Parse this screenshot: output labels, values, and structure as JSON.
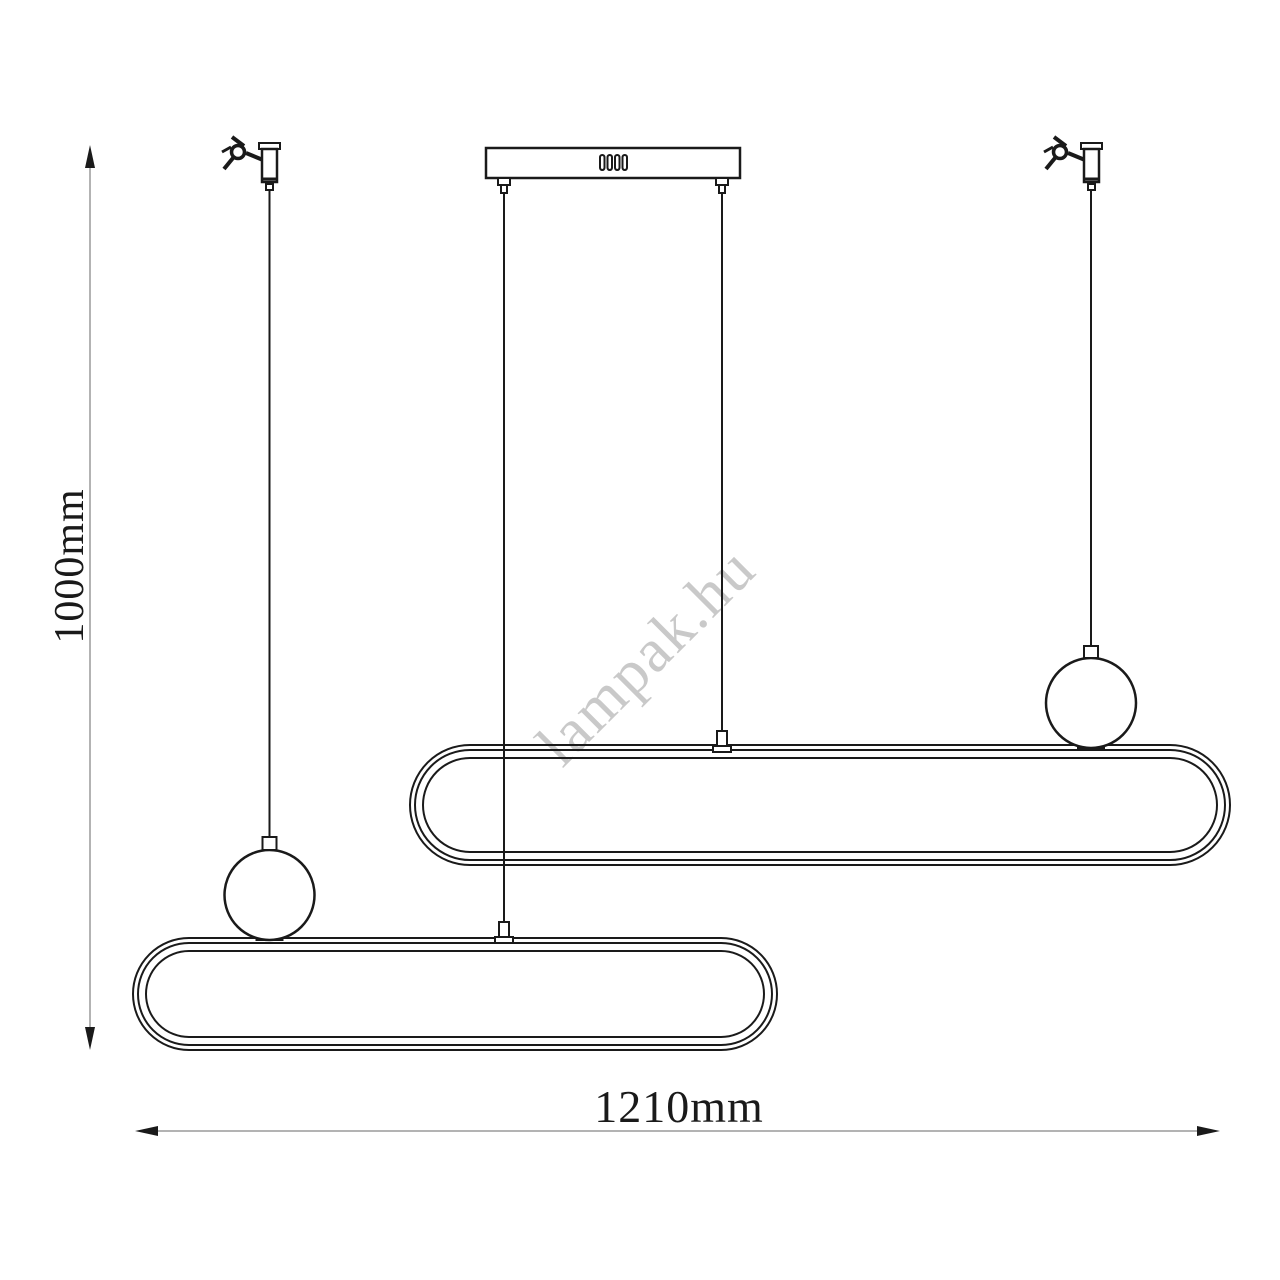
{
  "drawing": {
    "type": "pendant-lamp-technical-drawing",
    "height_dimension": {
      "label": "1000mm"
    },
    "width_dimension": {
      "label": "1210mm"
    },
    "watermark": "lampak.hu",
    "colors": {
      "line": "#1a1a1a",
      "dimension_line": "#b3b3b3",
      "arrow": "#1a1a1a",
      "text": "#1a1a1a",
      "watermark": "#c9c9c9",
      "background": "#ffffff"
    }
  }
}
